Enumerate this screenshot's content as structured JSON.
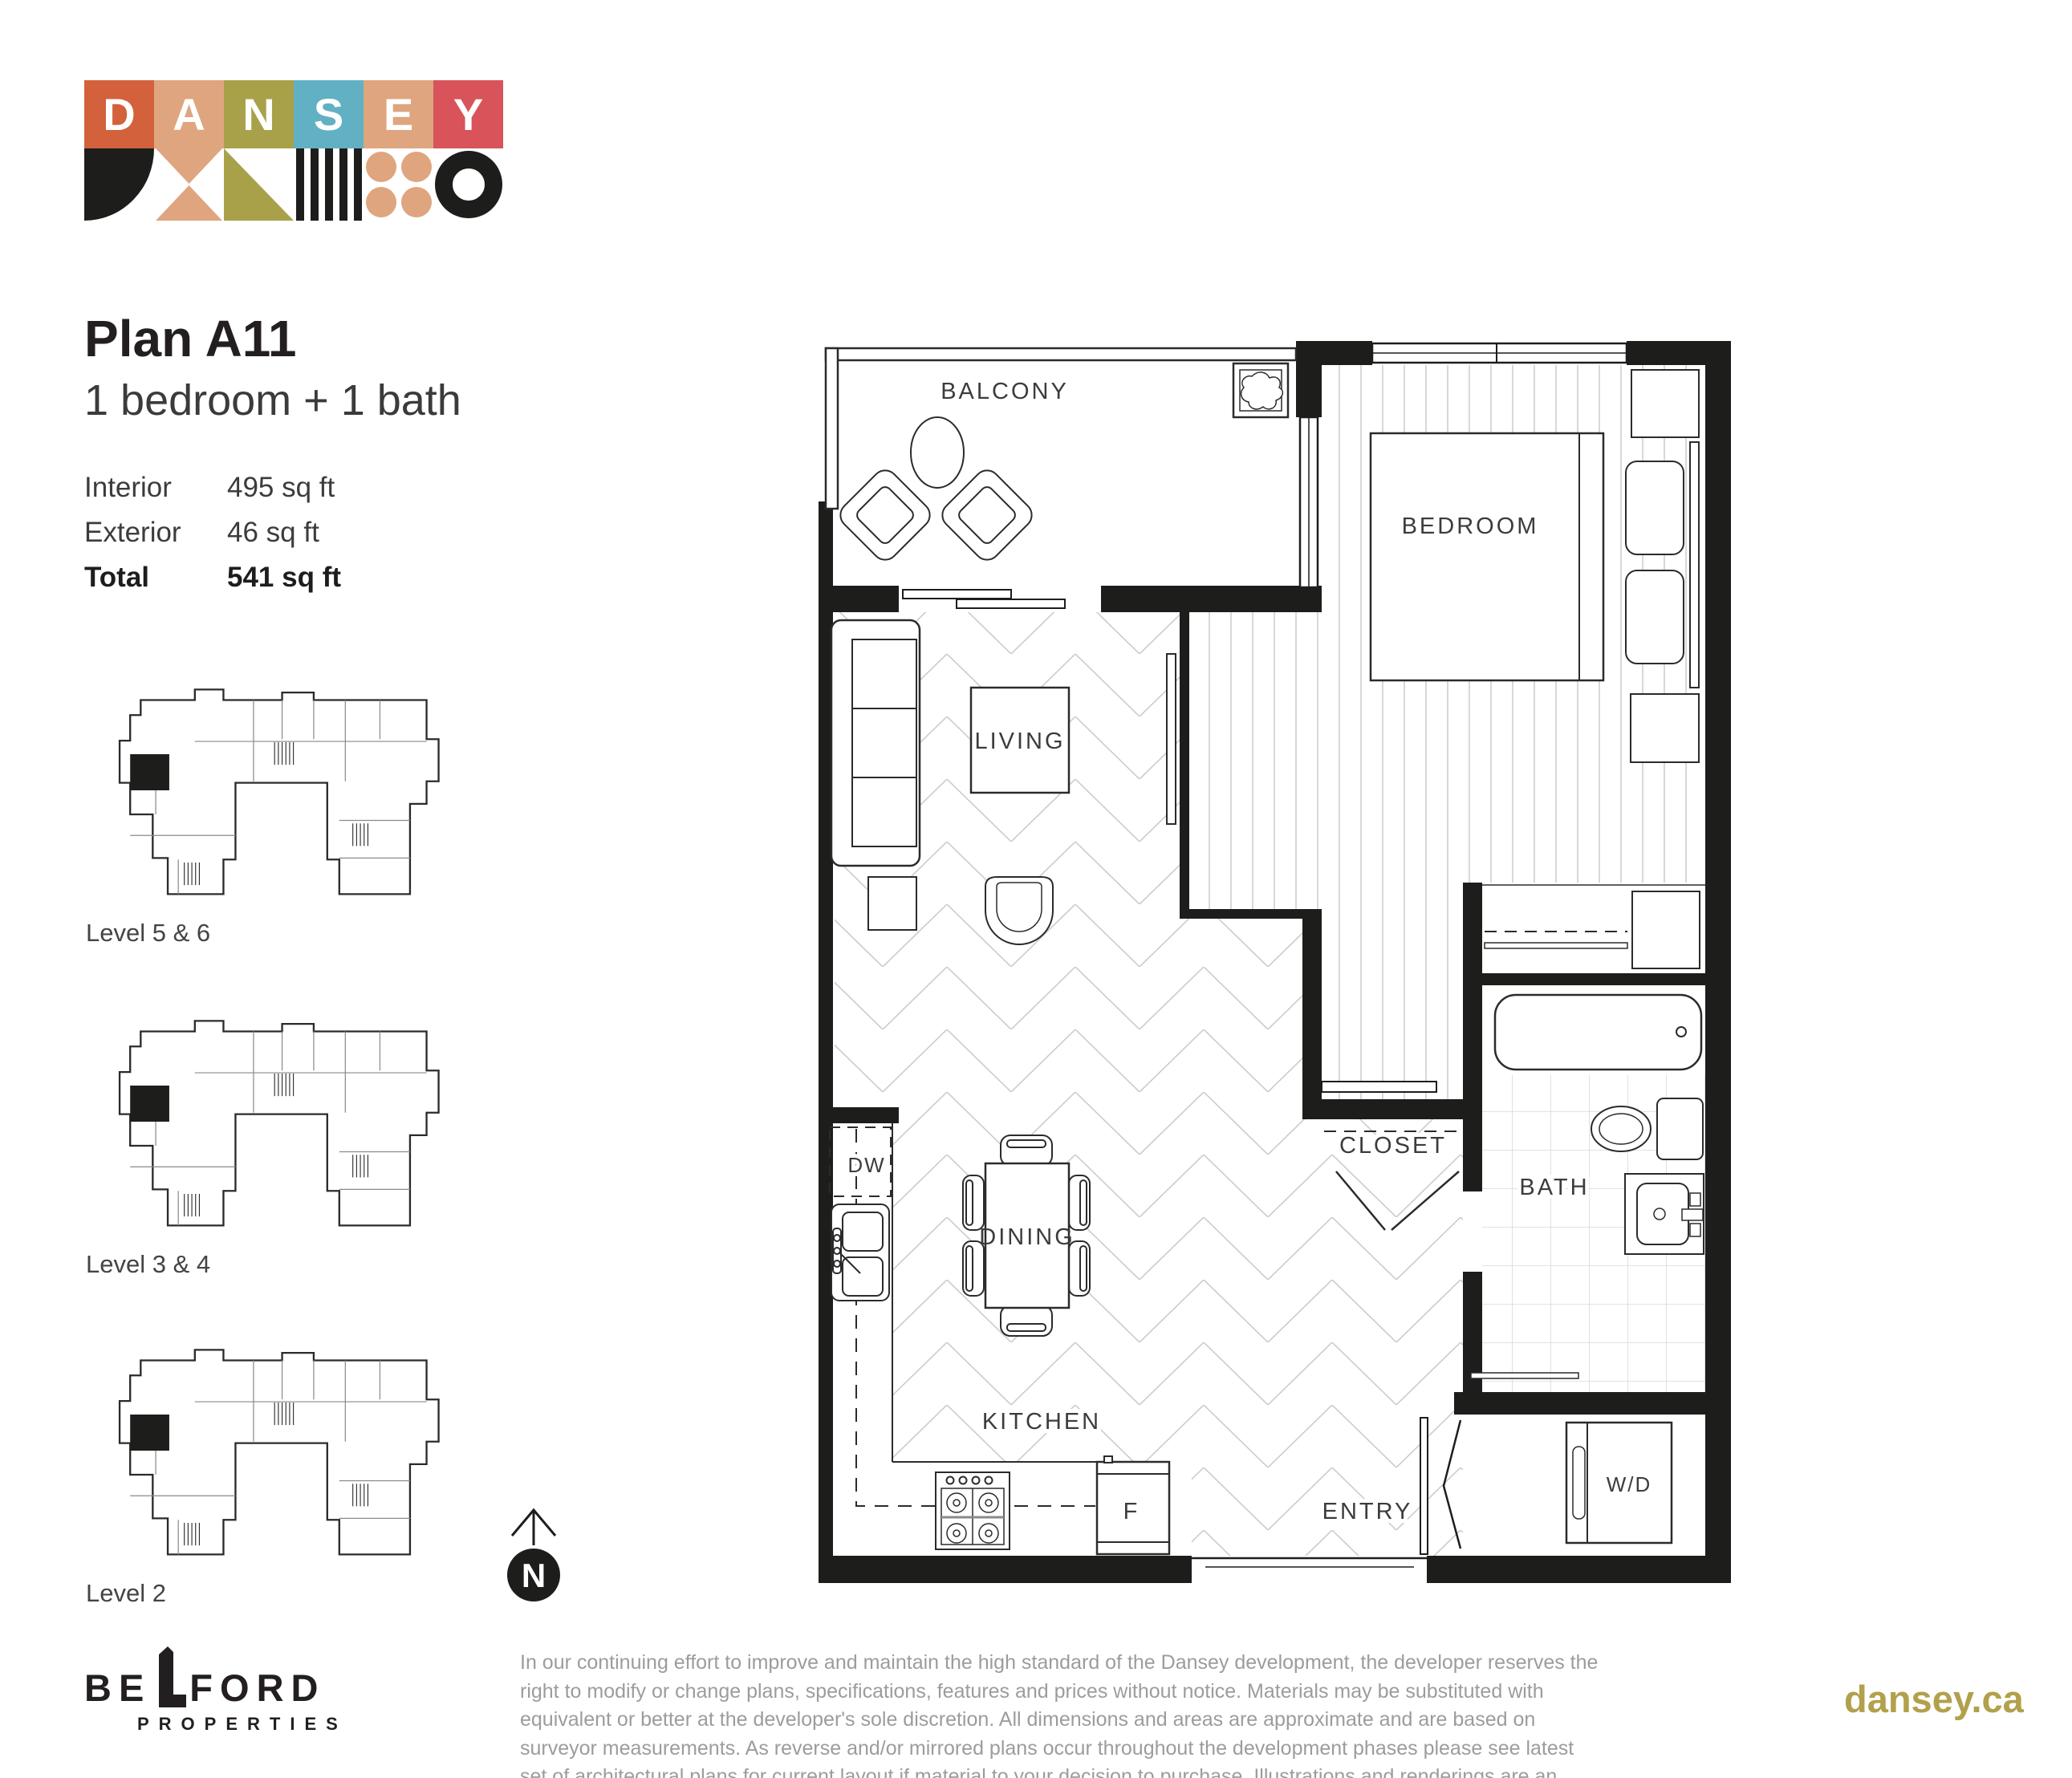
{
  "brand": {
    "logo_letters": [
      {
        "char": "D",
        "bg": "#d2613c"
      },
      {
        "char": "A",
        "bg": "#dfa57f"
      },
      {
        "char": "N",
        "bg": "#a9a14a"
      },
      {
        "char": "S",
        "bg": "#62b0c4"
      },
      {
        "char": "E",
        "bg": "#dfa57f"
      },
      {
        "char": "Y",
        "bg": "#d8545a"
      }
    ]
  },
  "plan": {
    "title": "Plan A11",
    "subtitle": "1 bedroom + 1 bath",
    "stats": [
      {
        "label": "Interior",
        "value": "495 sq ft"
      },
      {
        "label": "Exterior",
        "value": "46 sq ft"
      },
      {
        "label": "Total",
        "value": "541 sq ft"
      }
    ]
  },
  "keyplans": [
    {
      "label": "Level 5 & 6"
    },
    {
      "label": "Level 3 & 4"
    },
    {
      "label": "Level 2"
    }
  ],
  "compass": {
    "label": "N"
  },
  "floorplan": {
    "labels": {
      "balcony": "BALCONY",
      "bedroom": "BEDROOM",
      "living": "LIVING",
      "dining": "DINING",
      "kitchen": "KITCHEN",
      "closet": "CLOSET",
      "bath": "BATH",
      "entry": "ENTRY",
      "washer_dryer": "W/D",
      "dishwasher": "DW",
      "fridge": "F"
    }
  },
  "footer": {
    "developer_name_left": "BE",
    "developer_name_right": "FORD",
    "developer_sub": "PROPERTIES",
    "disclaimer": "In our continuing effort to improve and maintain the high standard of the Dansey development, the developer reserves the right to modify or change plans, specifications, features and prices without notice. Materials may be substituted with equivalent or better at the developer's sole discretion. All dimensions and areas are approximate and are based on surveyor measurements. As reverse and/or mirrored plans occur throughout the development phases please see latest set of architectural plans for current layout if material to your decision to purchase. Illustrations and renderings are an artist's conception and are intended as a general reference only. E.&O.E.",
    "website": "dansey.ca"
  },
  "colors": {
    "ink": "#1d1d1b",
    "tan": "#dfa57f",
    "olive": "#a9a14a",
    "teal": "#62b0c4",
    "orange": "#d2613c",
    "red": "#d8545a",
    "gold": "#b2a04b",
    "gray_text": "#9c9c9c"
  }
}
